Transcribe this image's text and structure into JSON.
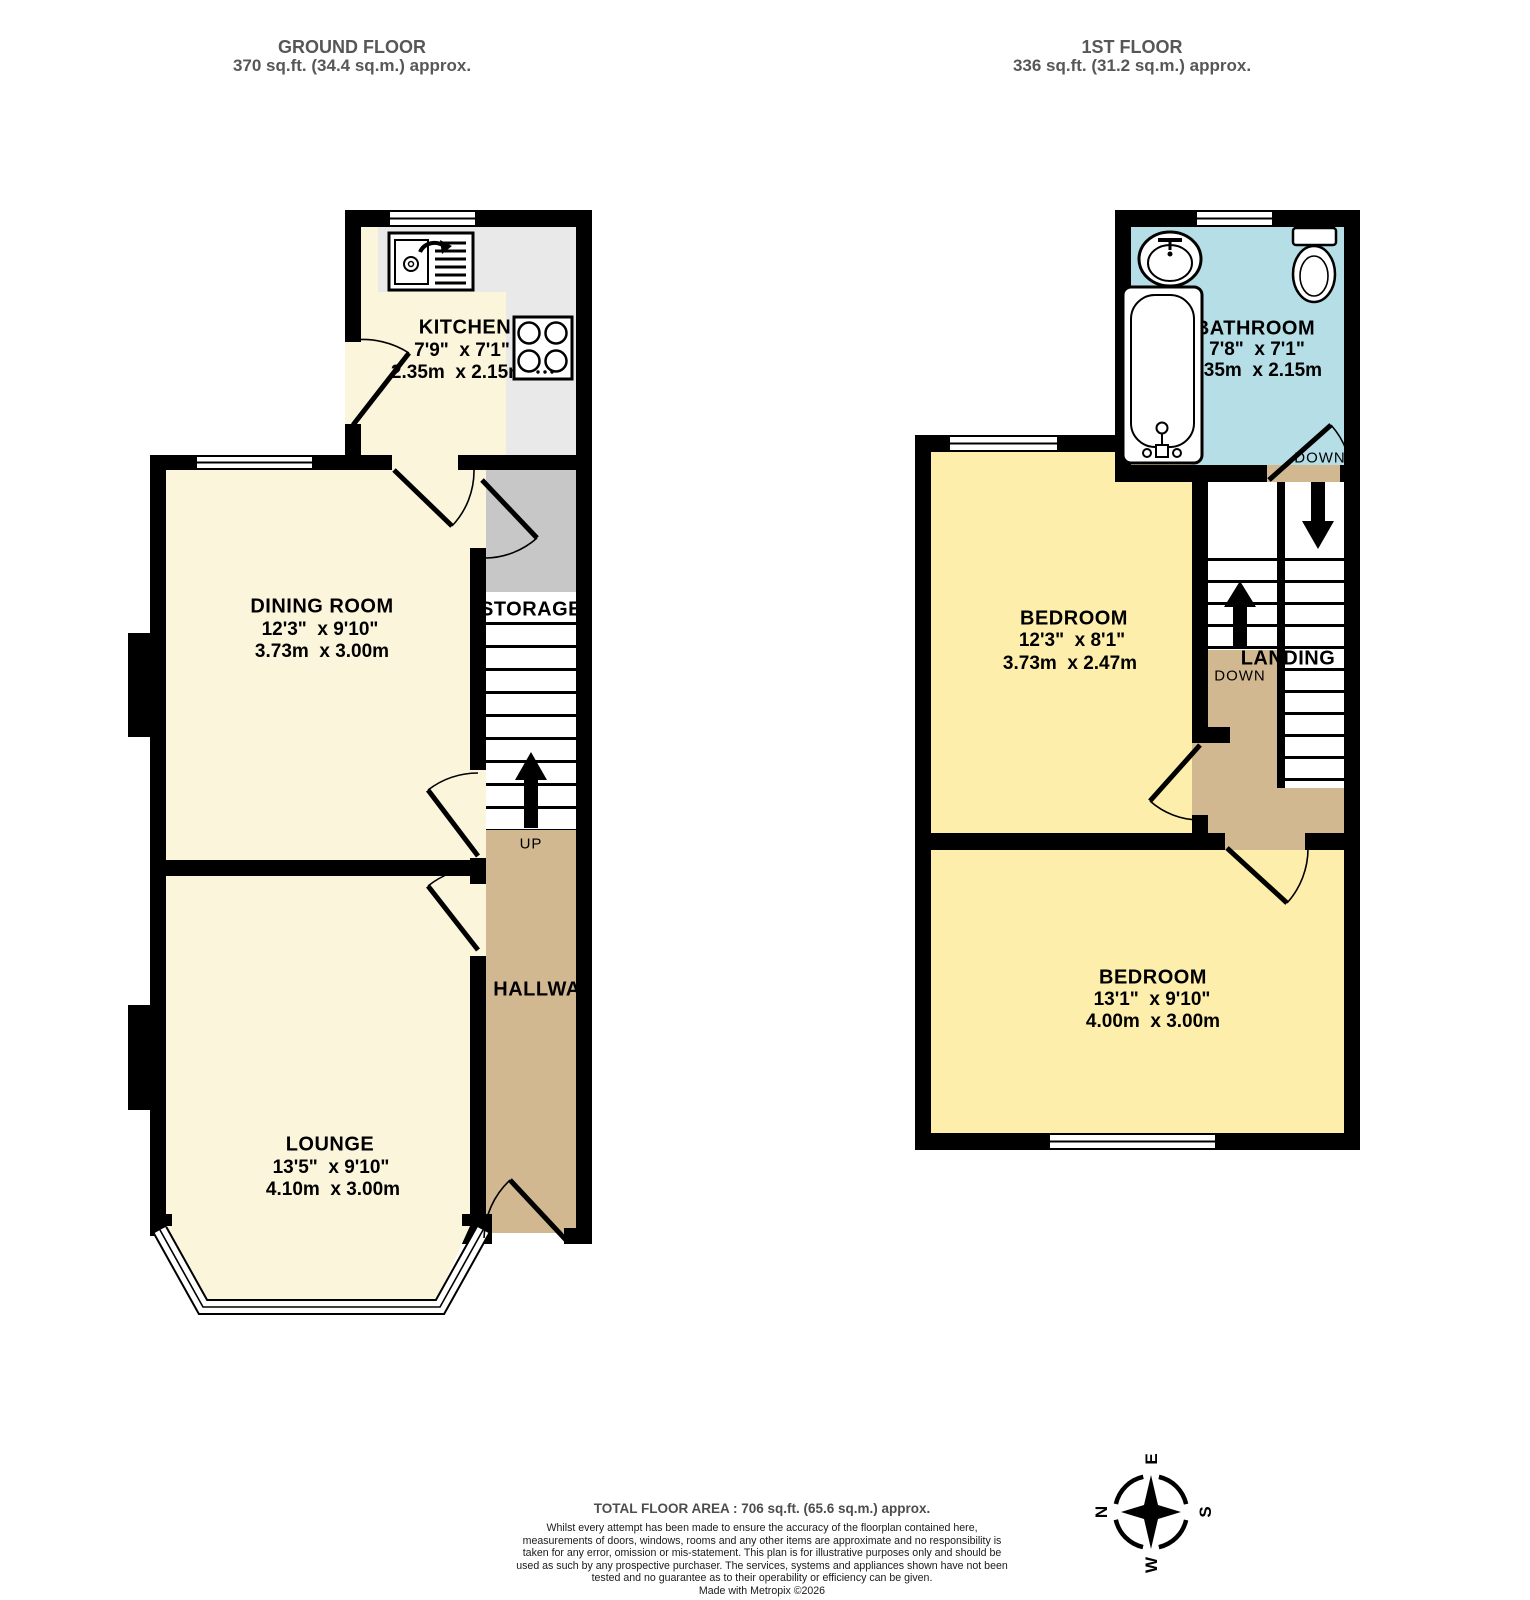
{
  "colors": {
    "wall": "#000000",
    "floor_cream": "#FBF5DC",
    "floor_yellow": "#FDEEAC",
    "floor_blue": "#B5DEE7",
    "floor_tan": "#D2B890",
    "counter_gray": "#E9E9E9",
    "storage_gray": "#C7C7C7",
    "header_text": "#575757",
    "footer_text": "#4D4D4D"
  },
  "ground_floor": {
    "title": "GROUND FLOOR",
    "area": "370 sq.ft. (34.4 sq.m.) approx.",
    "kitchen": {
      "name": "KITCHEN",
      "imperial": "7'9\"  x 7'1\"",
      "metric": "2.35m  x 2.15m"
    },
    "dining_room": {
      "name": "DINING ROOM",
      "imperial": "12'3\"  x 9'10\"",
      "metric": "3.73m  x 3.00m"
    },
    "lounge": {
      "name": "LOUNGE",
      "imperial": "13'5\"  x 9'10\"",
      "metric": "4.10m  x 3.00m"
    },
    "storage": {
      "name": "STORAGE"
    },
    "hallway": {
      "name": "HALLWAY"
    },
    "stairs": {
      "up": "UP"
    }
  },
  "first_floor": {
    "title": "1ST FLOOR",
    "area": "336 sq.ft. (31.2 sq.m.) approx.",
    "bathroom": {
      "name": "BATHROOM",
      "imperial": "7'8\"  x 7'1\"",
      "metric": "2.35m  x 2.15m",
      "door": "DOWN"
    },
    "bedroom_front": {
      "name": "BEDROOM",
      "imperial": "12'3\"  x 8'1\"",
      "metric": "3.73m  x 2.47m"
    },
    "bedroom_back": {
      "name": "BEDROOM",
      "imperial": "13'1\"  x 9'10\"",
      "metric": "4.00m  x 3.00m"
    },
    "landing": {
      "name": "LANDING",
      "down": "DOWN"
    }
  },
  "footer": {
    "total_area": "TOTAL FLOOR AREA : 706 sq.ft. (65.6 sq.m.) approx.",
    "disclaimer": "Whilst every attempt has been made to ensure the accuracy of the floorplan contained here, measurements of doors, windows, rooms and any other items are approximate and no responsibility is taken for any error, omission or mis-statement. This plan is for illustrative purposes only and should be used as such by any prospective purchaser. The services, systems and appliances shown have not been tested and no guarantee as to their operability or efficiency can be given.",
    "credit": "Made with Metropix ©2026"
  },
  "compass": {
    "n": "N",
    "e": "E",
    "s": "S",
    "w": "W"
  }
}
